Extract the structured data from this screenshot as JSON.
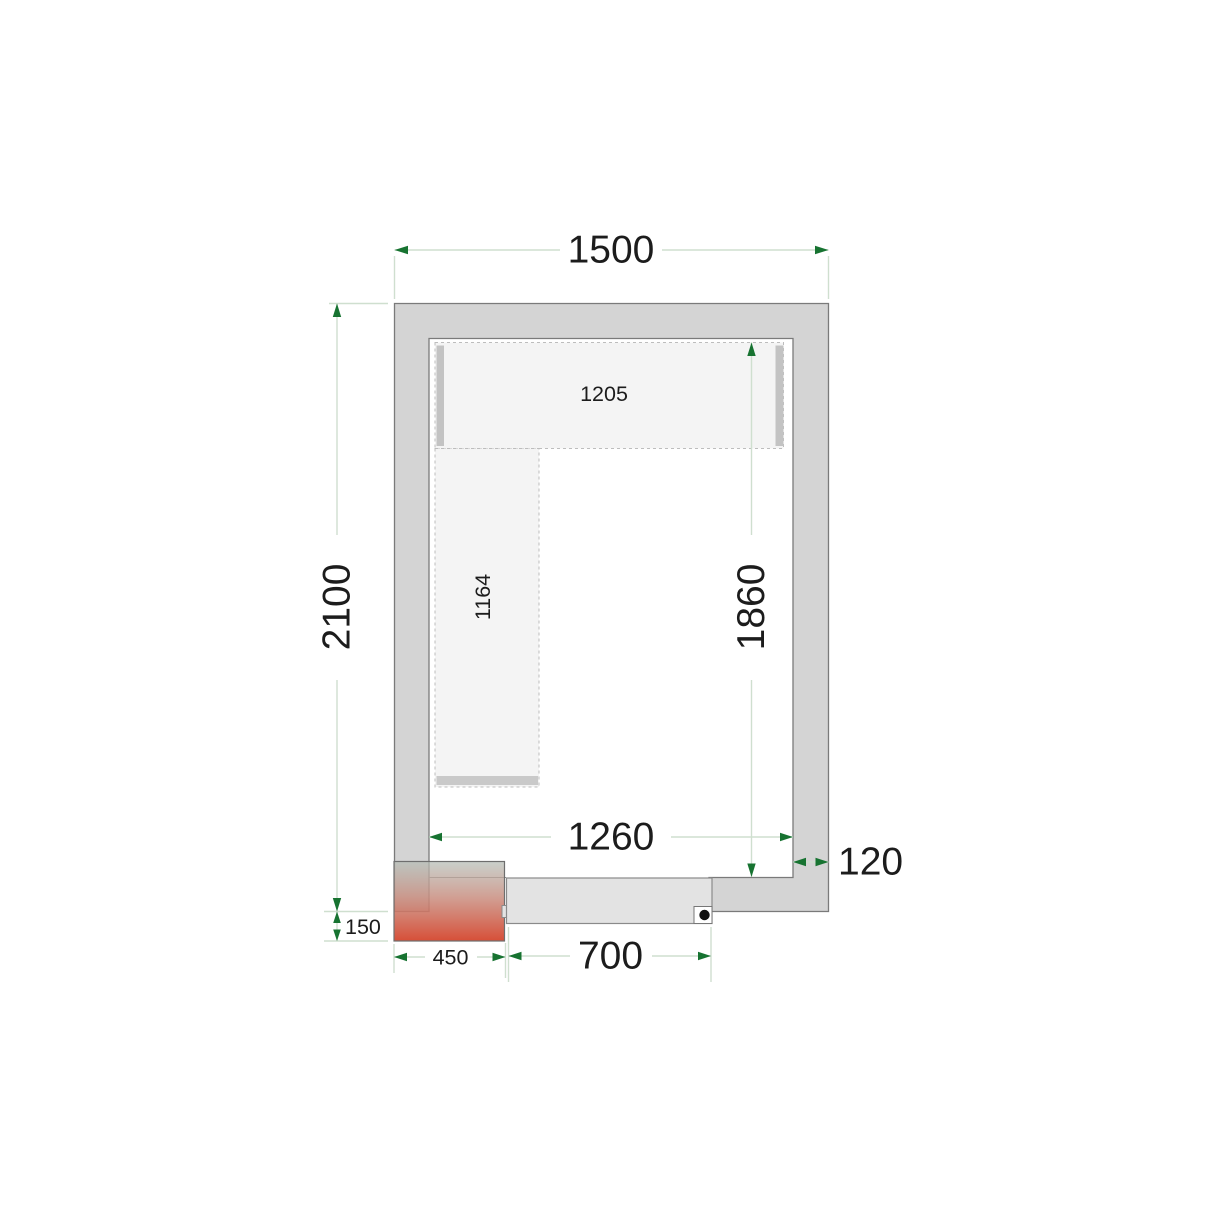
{
  "diagram": {
    "type": "cold-room-floor-plan-top-view",
    "units": "mm",
    "dimensions": {
      "outer_width": "1500",
      "outer_depth": "2100",
      "inner_width": "1260",
      "inner_depth": "1860",
      "wall_thickness": "120",
      "top_shelf_length": "1205",
      "side_shelf_length": "1164",
      "door_width": "700",
      "unit_width": "450",
      "unit_overhang": "150"
    },
    "colors": {
      "wall_fill": "#d4d4d4",
      "wall_outline": "#7a7a7a",
      "shelf_fill": "#f4f4f4",
      "shelf_dash": "#bdbdbd",
      "shelf_support_bar": "#c3c3c3",
      "dimension_line": "#cfdfcf",
      "dimension_arrow": "#177331",
      "label_text": "#1c1c1c",
      "door_fill": "#e3e3e3",
      "door_handle_dot": "#111111",
      "unit_gradient_top": "#b5bdb6",
      "unit_gradient_bottom": "#d5472f"
    }
  }
}
